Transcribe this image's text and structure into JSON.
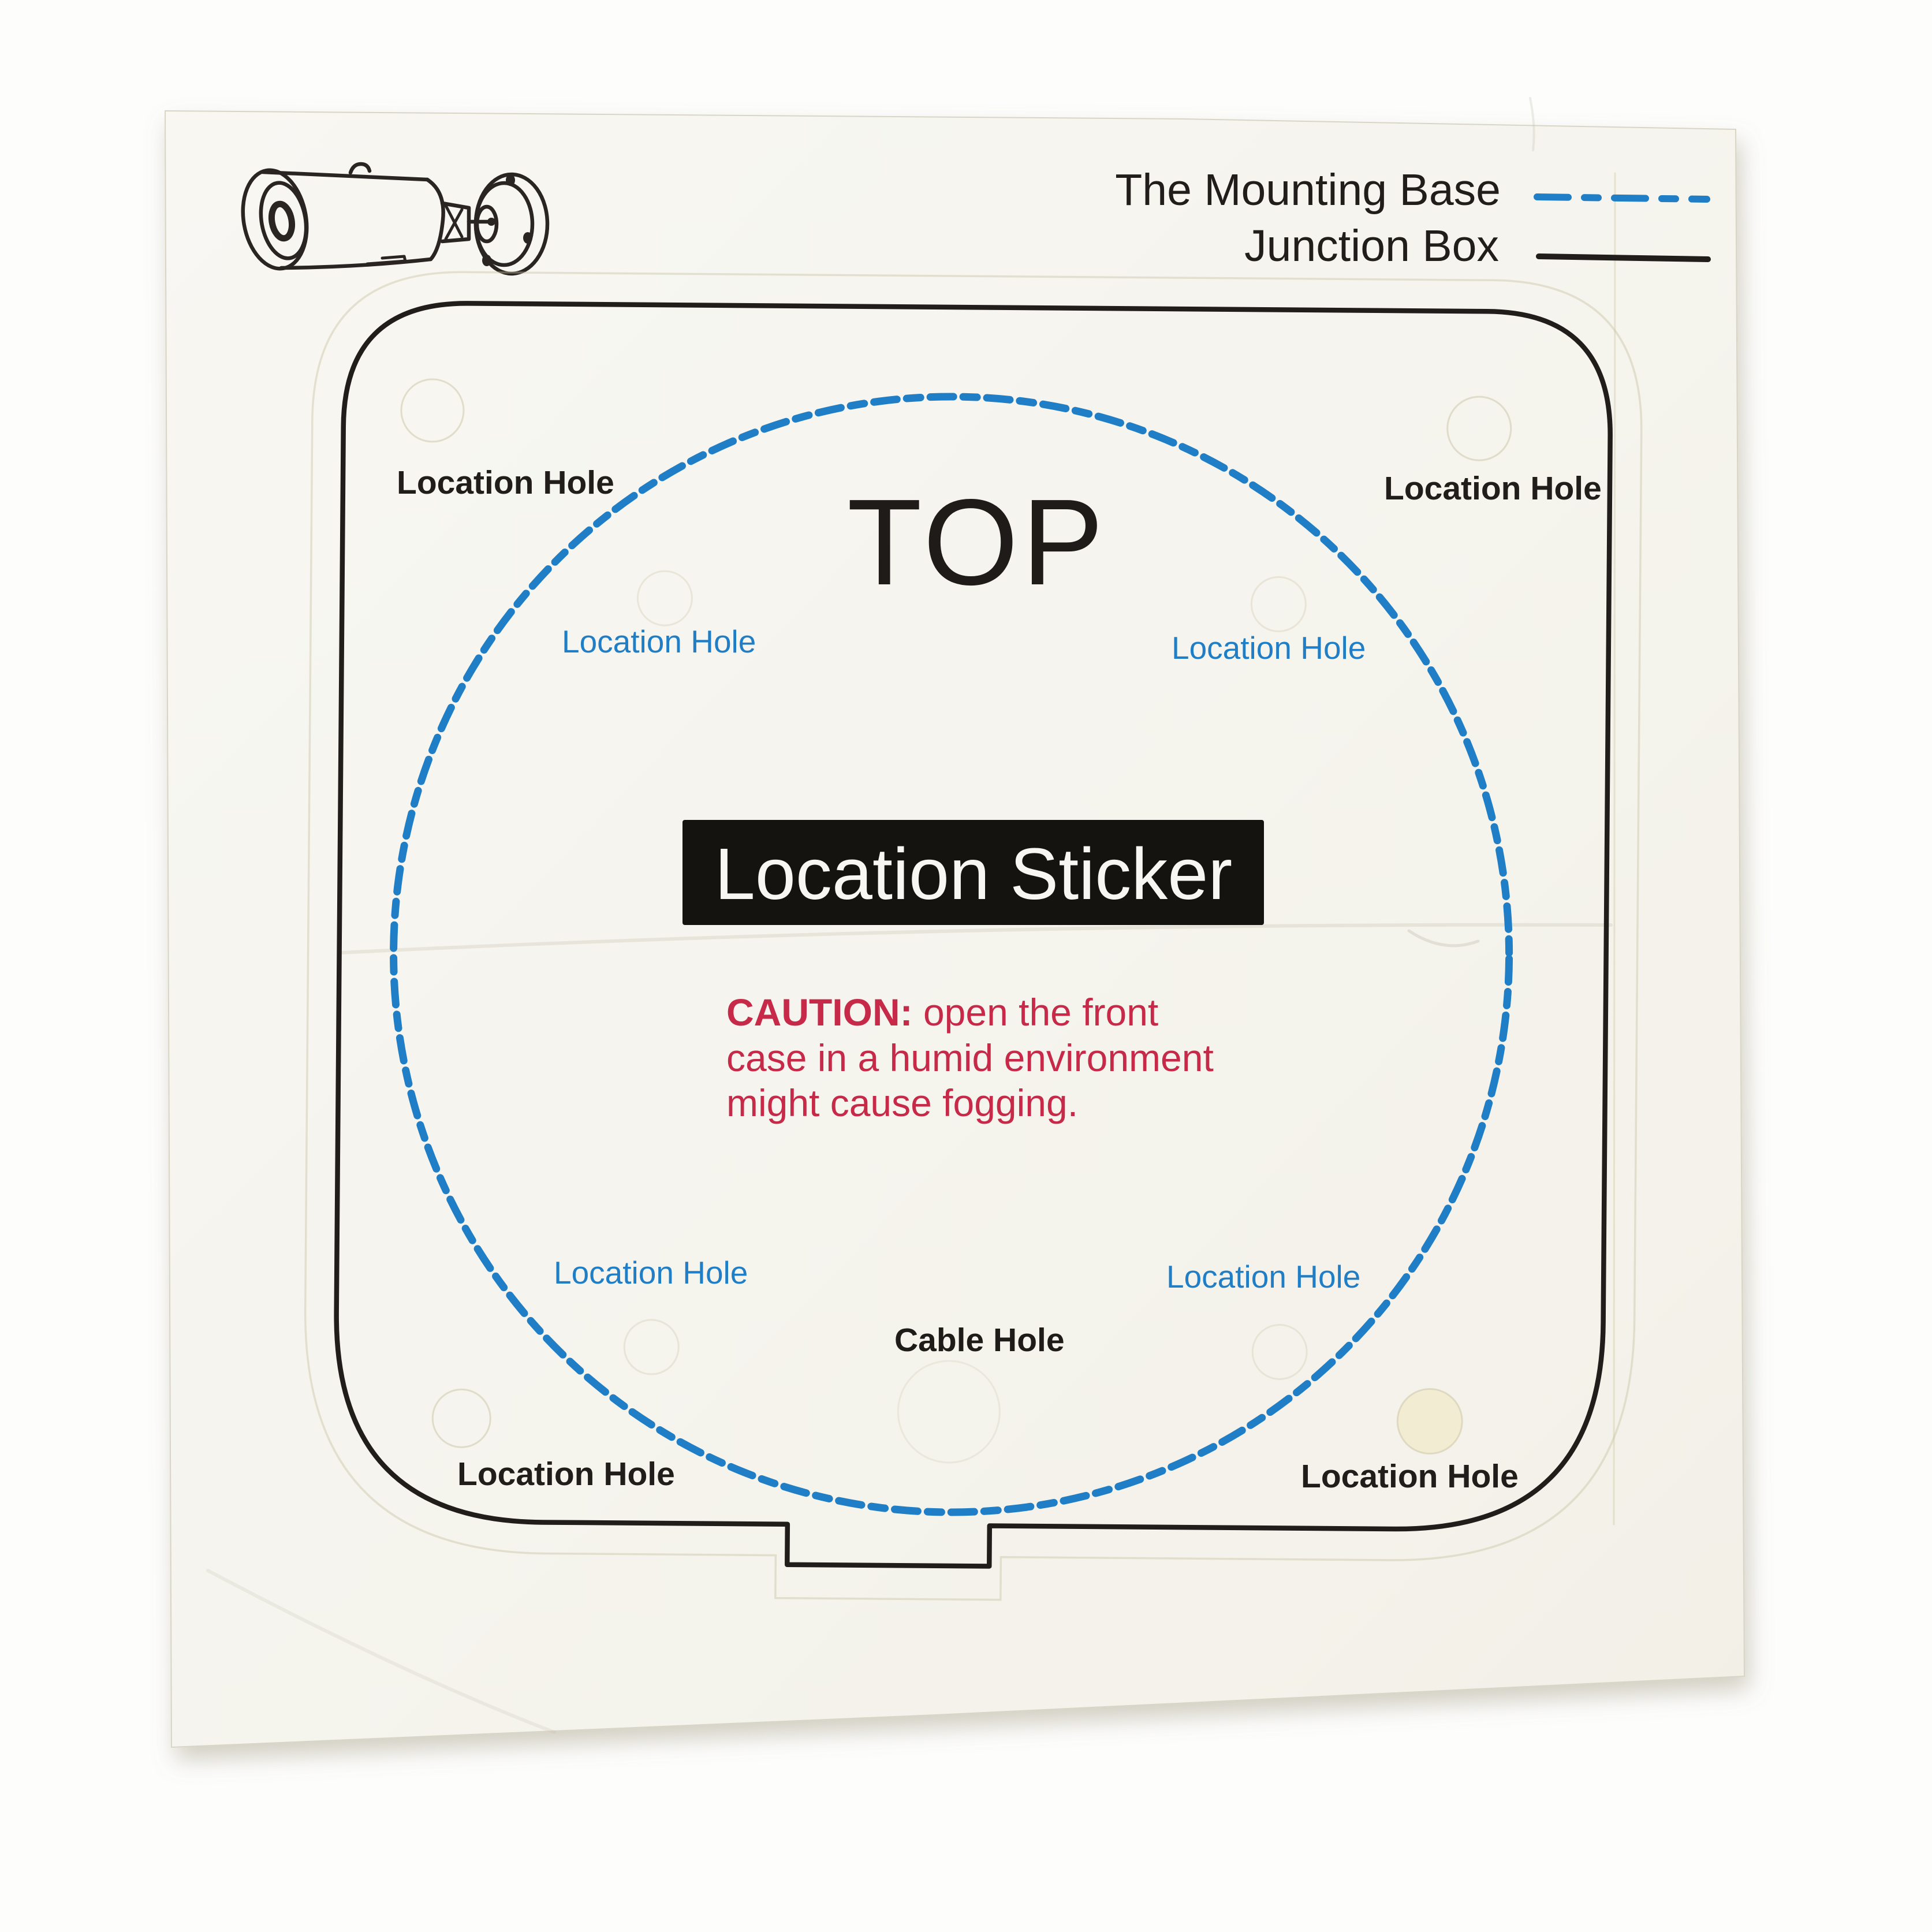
{
  "photo": {
    "camera_icon": "bullet-camera-line-drawing",
    "legend": {
      "items": [
        {
          "label": "The Mounting Base",
          "line_style": "blue-dash-dot",
          "color": "#1f7ec5"
        },
        {
          "label": "Junction Box",
          "line_style": "black-solid",
          "color": "#201d1a"
        }
      ]
    },
    "template": {
      "orientation_label": "TOP",
      "title": "Location Sticker",
      "caution": {
        "prefix": "CAUTION:",
        "line1_rest": " open the front",
        "line2": "case in a humid environment",
        "line3": "might cause fogging.",
        "color": "#c62a48"
      },
      "cable_hole_label": "Cable Hole",
      "junction_box_corner_labels": [
        "Location Hole",
        "Location Hole",
        "Location Hole",
        "Location Hole"
      ],
      "mounting_base_labels": [
        "Location Hole",
        "Location Hole",
        "Location Hole",
        "Location Hole"
      ]
    },
    "colors": {
      "blue": "#1f7ec5",
      "ink": "#201d1a",
      "red": "#c62a48",
      "paper": "#f5f4ee",
      "title_bg": "#151310",
      "title_text": "#f7f6f2"
    }
  }
}
